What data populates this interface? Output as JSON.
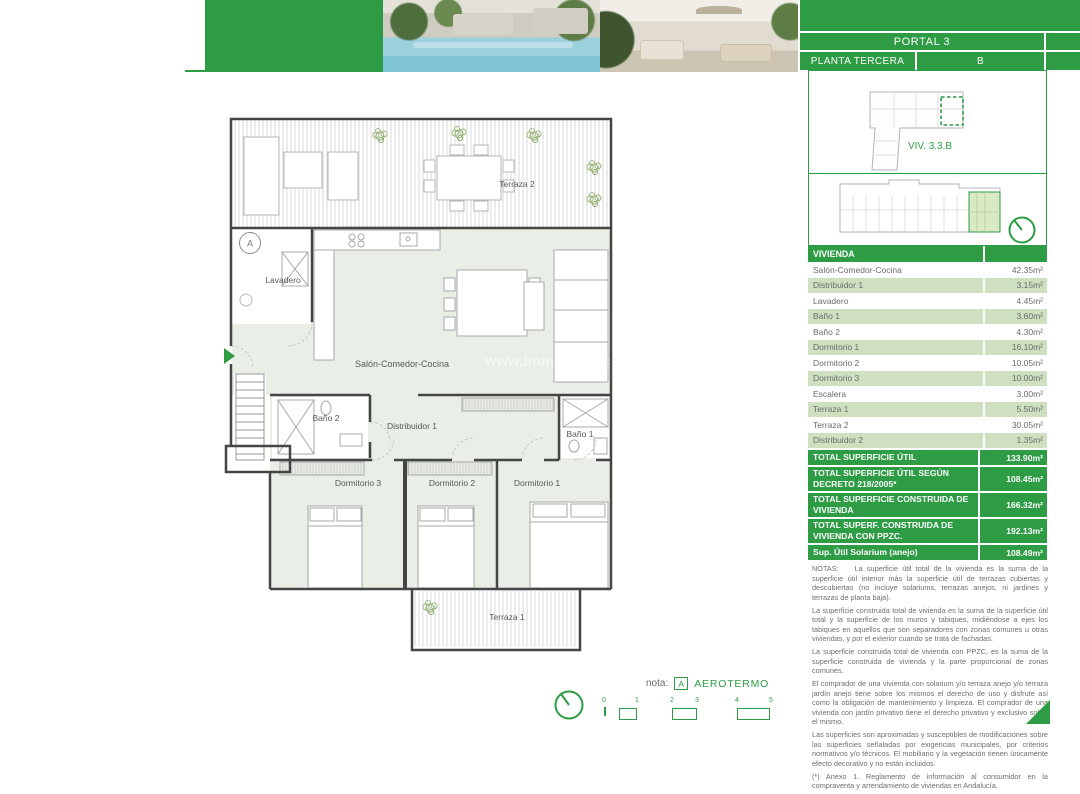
{
  "colors": {
    "green": "#2D9C44",
    "light_row": "#cfe0c0",
    "plan_fill": "#e9efe6"
  },
  "header": {
    "portal": "PORTAL 3",
    "planta": "PLANTA TERCERA",
    "letter": "B",
    "unit_label": "VIV. 3.3.B"
  },
  "watermark": "www.immo-toro.c",
  "table": {
    "title": "VIVIENDA",
    "rows": [
      {
        "label": "Salón-Comedor-Cocina",
        "value": "42.35m²"
      },
      {
        "label": "Distribuidor 1",
        "value": "3.15m²"
      },
      {
        "label": "Lavadero",
        "value": "4.45m²"
      },
      {
        "label": "Baño 1",
        "value": "3.60m²"
      },
      {
        "label": "Baño 2",
        "value": "4.30m²"
      },
      {
        "label": "Dormitorio 1",
        "value": "16.10m²"
      },
      {
        "label": "Dormitorio 2",
        "value": "10.05m²"
      },
      {
        "label": "Dormitorio 3",
        "value": "10.00m²"
      },
      {
        "label": "Escalera",
        "value": "3.00m²"
      },
      {
        "label": "Terraza 1",
        "value": "5.50m²"
      },
      {
        "label": "Terraza 2",
        "value": "30.05m²"
      },
      {
        "label": "Distribuidor 2",
        "value": "1.35m²"
      }
    ],
    "totals": [
      {
        "label": "TOTAL SUPERFICIE ÚTIL",
        "value": "133.90m²"
      },
      {
        "label": "TOTAL SUPERFICIE ÚTIL SEGÚN DECRETO 218/2005*",
        "value": "108.45m²"
      },
      {
        "label": "TOTAL SUPERFICIE CONSTRUIDA DE VIVIENDA",
        "value": "166.32m²"
      },
      {
        "label": "TOTAL SUPERF. CONSTRUIDA DE VIVIENDA CON PPZC.",
        "value": "192.13m²"
      },
      {
        "label": "Sup. Útil Solarium (anejo)",
        "value": "108.49m²"
      }
    ]
  },
  "notes": {
    "label": "NOTAS:",
    "lines": [
      "La superficie útil total de la vivienda es la suma de la superficie útil interior más la superficie útil de terrazas cubiertas y descubiertas (no incluye solariums, terrazas anejos, ni jardines y terrazas de planta baja).",
      "La superficie construida total de vivienda es la suma de la superficie útil total y la superficie de los muros y tabiques, midiéndose a ejes los tabiques en aquellos que son separadores con zonas comunes u otras viviendas, y por el exterior cuando se trata de fachadas.",
      "La superficie construida total de vivienda con PPZC, es la suma de la superficie construida de vivienda y la parte proporcional de zonas comunes.",
      "El comprador de una vivienda con solarium y/o terraza anejo y/o terraza jardín anejo tiene sobre los mismos el derecho de uso y disfrute así como la obligación de mantenimiento y limpieza. El comprador de una vivienda con jardín privativo tiene el derecho privativo y exclusivo sobre el mismo.",
      "Las superficies son aproximadas y susceptibles de modificaciones sobre las superficies señaladas por exigencias municipales, por criterios normativos y/o técnicos. El mobiliario y la vegetación tienen únicamente efecto decorativo y no están incluidos.",
      "(*) Anexo 1. Reglamento de información al consumidor en la compraventa y arrendamiento de viviendas en Andalucía."
    ]
  },
  "plan": {
    "terraza2": "Terraza 2",
    "lavadero": "Lavadero",
    "salon": "Salón-Comedor-Cocina",
    "bano2": "Baño 2",
    "distribuidor1": "Distribuidor 1",
    "bano1": "Baño 1",
    "dorm3": "Dormitorio 3",
    "dorm2": "Dormitorio 2",
    "dorm1": "Dormitorio 1",
    "terraza1": "Terraza 1",
    "marker_a": "A"
  },
  "footer": {
    "nota_label": "nota:",
    "marker": "A",
    "nota_value": "AEROTERMO",
    "scale": [
      "0",
      "1",
      "2",
      "3",
      "4",
      "5"
    ]
  }
}
